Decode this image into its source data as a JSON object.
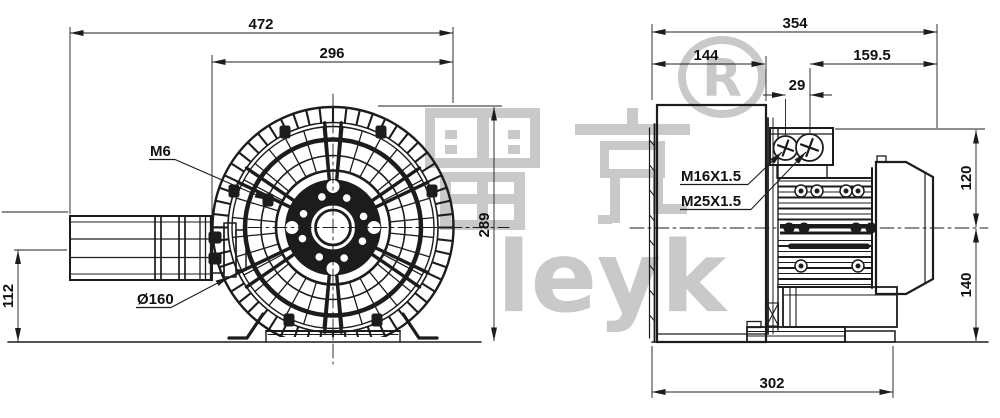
{
  "watermark": {
    "cjk": "雷克",
    "latin": "leyk",
    "registered_symbol": "®",
    "registered_letter": "R",
    "color": "#c9c9c9"
  },
  "front_view": {
    "dim_overall_width": "472",
    "dim_guard_width": "296",
    "dim_overall_height": "289",
    "dim_silencer_axis_height": "112",
    "label_guard_screw": "M6",
    "label_port_diameter": "Ø160"
  },
  "side_view": {
    "dim_overall_length": "354",
    "dim_housing_depth": "144",
    "dim_motor_length": "159.5",
    "dim_gland_spacing": "29",
    "dim_box_top_to_axis": "120",
    "dim_axis_to_base": "140",
    "dim_base_length": "302",
    "label_cable_gland_small": "M16X1.5",
    "label_cable_gland_large": "M25X1.5"
  },
  "colors": {
    "line": "#1c1c1c",
    "background": "#ffffff",
    "watermark": "#c9c9c9"
  }
}
